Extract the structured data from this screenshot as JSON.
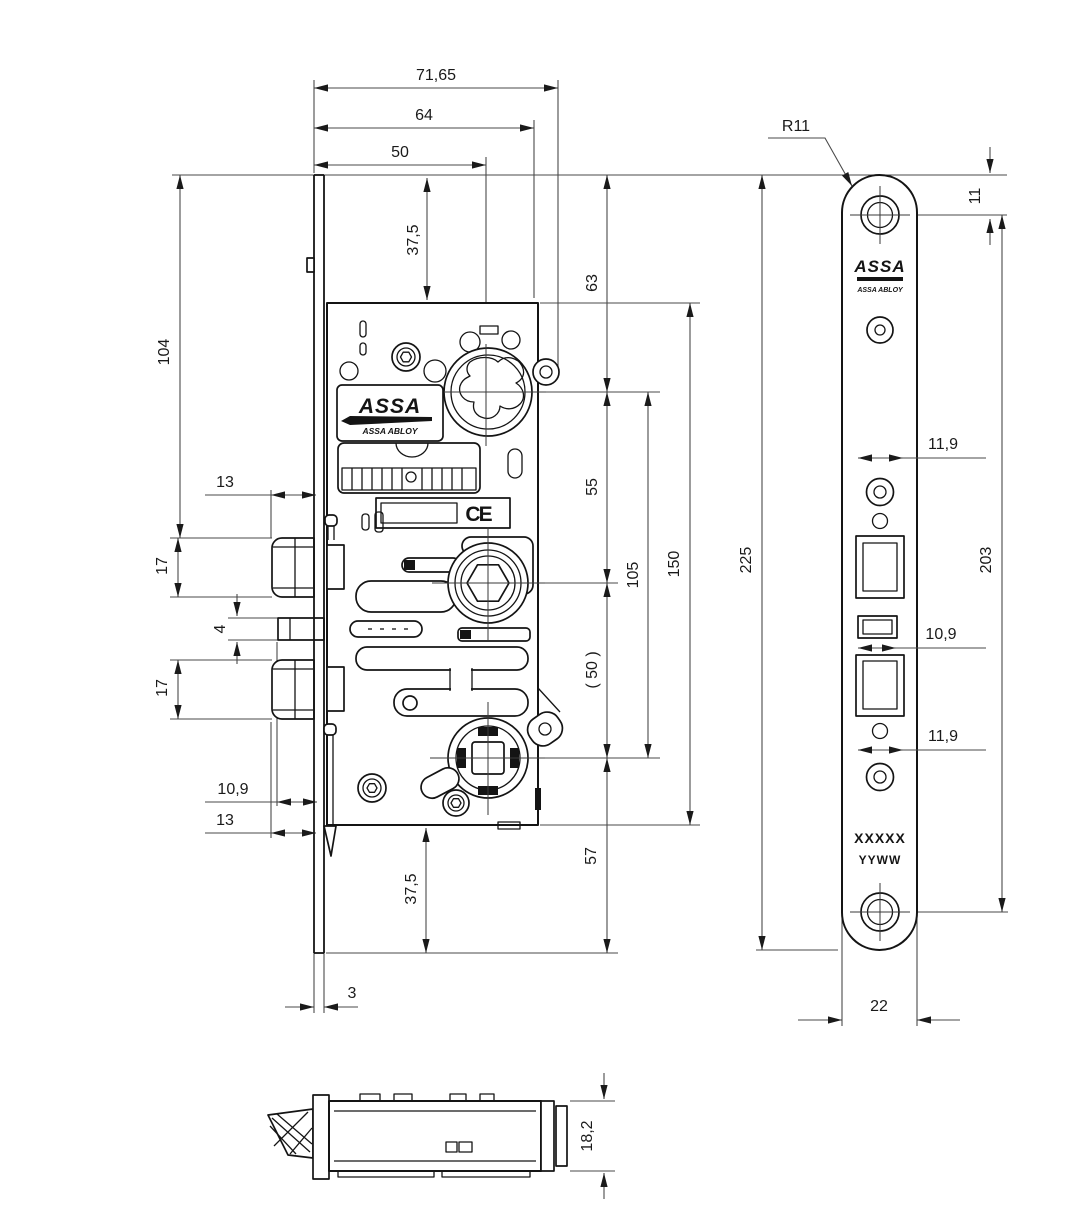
{
  "title": "ASSA ABLOY mortise lock technical drawing",
  "brand": {
    "logo_primary": "ASSA",
    "logo_secondary": "ASSA ABLOY"
  },
  "front_view": {
    "dims": {
      "total_depth": "71,65",
      "case_depth": "64",
      "backset": "50",
      "top_margin": "37,5",
      "top_to_cylinder": "63",
      "cylinder_to_hub": "55",
      "hub_to_spindle": "( 50 )",
      "spindle_to_bottom": "57",
      "cylinder_to_spindle": "105",
      "case_height": "150",
      "top_to_latch": "104",
      "latch_protrusion": "13",
      "latch_height": "17",
      "aux_height": "4",
      "deadbolt_height": "17",
      "aux_protrusion": "10,9",
      "deadbolt_protrusion": "13",
      "bottom_margin": "37,5",
      "faceplate_thickness": "3",
      "ce_mark": "CE"
    }
  },
  "faceplate_view": {
    "dims": {
      "corner_radius": "R11",
      "screw_to_top": "11",
      "plate_height": "225",
      "screw_spacing": "203",
      "latch_cutout_width": "11,9",
      "aux_cutout_width": "10,9",
      "deadbolt_cutout_width": "11,9",
      "plate_width": "22"
    },
    "markings": {
      "line1": "XXXXX",
      "line2": "YYWW"
    }
  },
  "bottom_view": {
    "dims": {
      "case_thickness": "18,2"
    }
  }
}
